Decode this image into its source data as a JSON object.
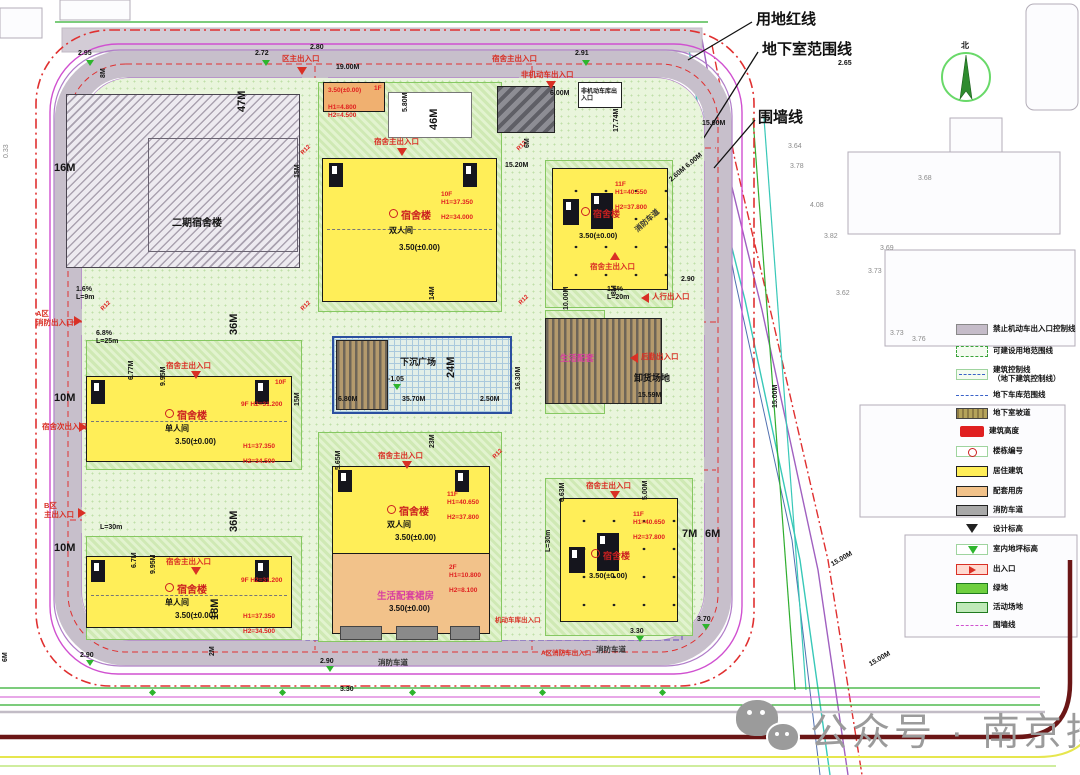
{
  "callouts": {
    "land_red_line": "用地红线",
    "basement_line": "地下室范围线",
    "wall_line": "围墙线"
  },
  "north_label": "北",
  "watermark": "公众号 · 南京择校",
  "radius_label": "R12",
  "road_labels": [
    "消防车道",
    "消防车道",
    "消防车道"
  ],
  "buildings": {
    "phase2": {
      "name": "二期宿舍楼"
    },
    "gate": {
      "elev": "3.50(±0.00)",
      "floors": "1F",
      "h1": "H1=4.800",
      "h2": "H2=4.500"
    },
    "dorm_n": {
      "name": "宿舍楼",
      "room": "双人间",
      "elev": "3.50(±0.00)",
      "floors": "10F",
      "h1": "H1=37.350",
      "h2": "H2=34.000"
    },
    "dorm_ne": {
      "name": "宿舍楼",
      "elev": "3.50(±0.00)",
      "floors": "11F",
      "h1": "H1=40.550",
      "h2": "H2=37.800"
    },
    "dorm_w": {
      "name": "宿舍楼",
      "room": "单人间",
      "elev": "3.50(±0.00)",
      "corner": "10F",
      "side_floors": "9F",
      "side_h": "H2=31.200",
      "h1": "H1=37.350",
      "h2": "H2=34.500"
    },
    "dorm_sw": {
      "name": "宿舍楼",
      "room": "单人间",
      "elev": "3.50(±0.00)",
      "side_floors": "9F",
      "side_h": "H2=31.200",
      "h1": "H1=37.350",
      "h2": "H2=34.500"
    },
    "dorm_s": {
      "name": "宿舍楼",
      "room": "双人间",
      "elev": "3.50(±0.00)",
      "floors": "11F",
      "h1": "H1=40.650",
      "h2": "H2=37.800"
    },
    "podium": {
      "name": "生活配套裙房",
      "elev": "3.50(±0.00)",
      "floors": "2F",
      "h1": "H1=10.800",
      "h2": "H2=8.100"
    },
    "dorm_se": {
      "name": "宿舍楼",
      "elev": "3.50(±0.00)",
      "floors": "11F",
      "h1": "H1=40.650",
      "h2": "H2=37.800"
    },
    "service": {
      "name": "生活配套",
      "elev": "3.50(±0.00)"
    },
    "plaza": {
      "name": "下沉广场"
    },
    "unload": {
      "name": "卸货场地"
    },
    "bike": {
      "name": "非机动车库出入口"
    }
  },
  "entrances": [
    "区主出入口",
    "宿舍主出入口",
    "非机动车出入口",
    "宿舍主出入口",
    "宿舍主出入口",
    "宿舍主出入口",
    "宿舍主出入口",
    "宿舍主出入口",
    "宿舍主出入口",
    "人行出入口",
    "A区\n消防出入口",
    "宿舍次出入口",
    "B区\n主出入口",
    "后勤出入口",
    "机动车库出入口",
    "A区消防车出入口"
  ],
  "dims": [
    "2.95",
    "2.72",
    "2.80",
    "19.00M",
    "2.91",
    "2.65",
    "46M",
    "5.80M",
    "6.00M",
    "15.20M",
    "17.74M",
    "15.00M",
    "8M",
    "47M",
    "16M",
    "15M",
    "36M",
    "15M",
    "36M",
    "10M",
    "10M",
    "6.8%\nL=25m",
    "1.6%\nL=9m",
    "L=30m",
    "6.77M",
    "9.95M",
    "6.7M",
    "9.95M",
    "18M",
    "2M",
    "2.90",
    "2.90",
    "6M",
    "24M",
    "35.70M",
    "6.80M",
    "2.50M",
    "-1.05",
    "23M",
    "14M",
    "16.30M",
    "10.00M",
    "15.59M",
    "5.65M",
    "6.63M",
    "5.00M",
    "7M",
    "6M",
    "L=30m",
    "3.30",
    "3.70",
    "3.30",
    "15.00M",
    "15.00M",
    "15.00M",
    "2.60M 6.00M",
    "8M",
    "6M",
    "1.5%\nL=20m",
    "2.90"
  ],
  "spots": [
    "3.64",
    "3.78",
    "4.08",
    "3.82",
    "3.73",
    "3.68",
    "3.69",
    "3.62",
    "3.73",
    "3.76",
    "0.33"
  ],
  "legend": {
    "items": [
      {
        "label": "禁止机动车出入口控制线"
      },
      {
        "label": "可建设用地范围线"
      },
      {
        "label": "建筑控制线\n（地下建筑控制线）"
      },
      {
        "label": "地下车库范围线"
      },
      {
        "label": "地下室坡道"
      },
      {
        "label": "建筑高度"
      },
      {
        "label": "楼栋编号"
      },
      {
        "label": "居住建筑"
      },
      {
        "label": "配套用房"
      },
      {
        "label": "消防车道"
      },
      {
        "label": "设计标高"
      },
      {
        "label": "室内地坪标高"
      },
      {
        "label": "出入口"
      },
      {
        "label": "绿地"
      },
      {
        "label": "活动场地"
      },
      {
        "label": "围墙线"
      }
    ]
  }
}
